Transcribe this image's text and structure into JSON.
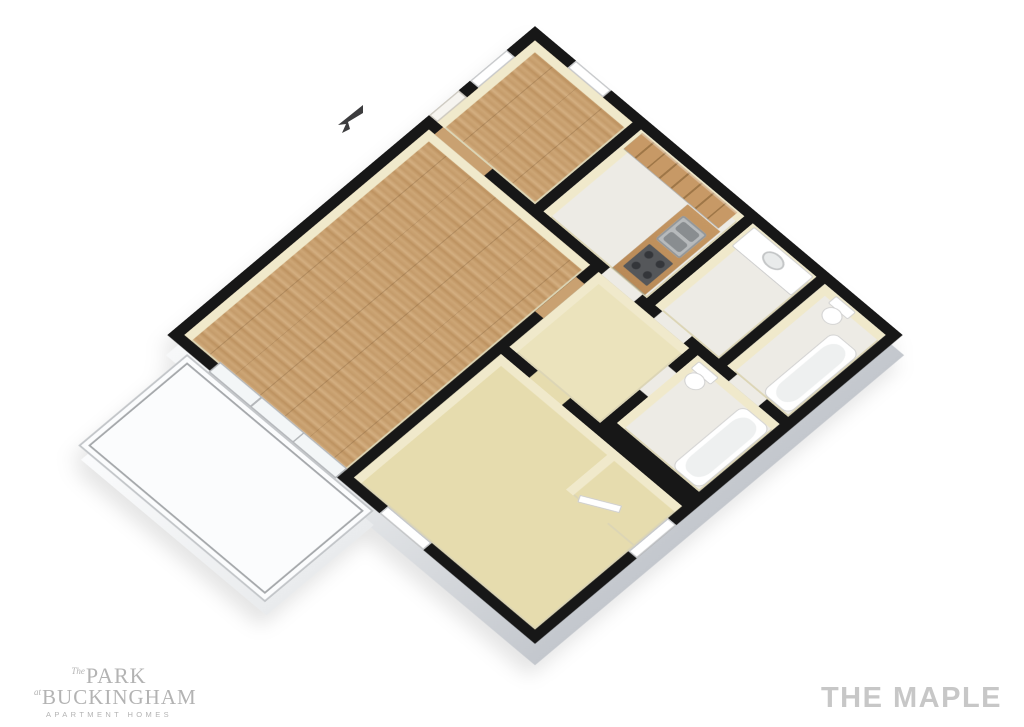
{
  "branding": {
    "logo": {
      "prefix1": "The",
      "word1": "Park",
      "prefix2": "at",
      "word2": "Buckingham",
      "tagline": "APARTMENT HOMES",
      "color": "#b3b3b3"
    },
    "title": {
      "text": "THE MAPLE",
      "color": "#c7c7c7"
    }
  },
  "floorplan": {
    "type": "3d-isometric-floor-plan",
    "unit_name": "The Maple",
    "colors": {
      "walls": "#171717",
      "wall_faces": "#f0e9cb",
      "wood_floor": "#c8a172",
      "carpet_floor": "#e6dcae",
      "tile_floor": "#edebe5",
      "cabinets": "#bf9465",
      "slab_side": "#c9cdd2",
      "patio_floor": "#fbfcfd",
      "railing": "#a4a7aa",
      "fixtures": "#ffffff"
    },
    "rooms": [
      {
        "name": "dining-area",
        "floor": "wood"
      },
      {
        "name": "kitchen",
        "floor": "tile"
      },
      {
        "name": "bathroom-vanity",
        "floor": "tile"
      },
      {
        "name": "bathroom",
        "floor": "tile"
      },
      {
        "name": "living-room",
        "floor": "wood"
      },
      {
        "name": "hallway",
        "floor": "carpet"
      },
      {
        "name": "second-bathroom",
        "floor": "tile"
      },
      {
        "name": "bedroom",
        "floor": "carpet"
      },
      {
        "name": "closet",
        "floor": "carpet"
      },
      {
        "name": "patio",
        "floor": "concrete"
      }
    ],
    "fixtures": [
      "kitchen-cabinets",
      "kitchen-sink",
      "range",
      "vanity-sink",
      "toilet",
      "bathtub",
      "sliding-glass-door",
      "windows",
      "entry-door"
    ],
    "compass": {
      "type": "entry-arrow",
      "direction": "toward-entry-wall"
    }
  }
}
